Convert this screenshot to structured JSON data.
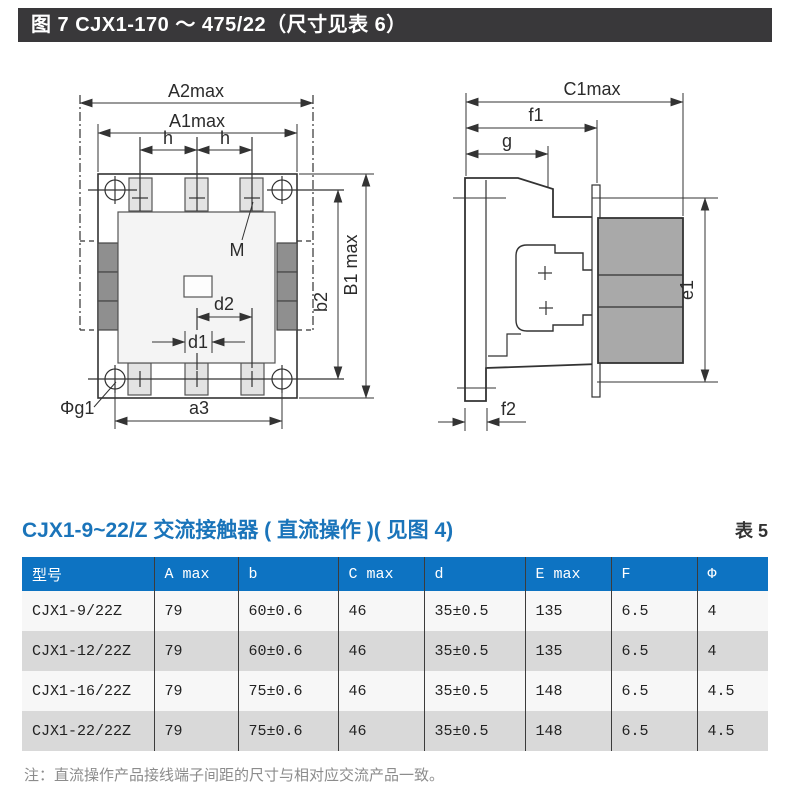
{
  "header_bar": {
    "text": "图 7 CJX1-170 ～ 475/22（尺寸见表 6）",
    "bg": "#39383a",
    "fg": "#ffffff"
  },
  "fig": {
    "front": {
      "a2max": "A2max",
      "a1max": "A1max",
      "h1": "h",
      "h2": "h",
      "m": "M",
      "b2": "b2",
      "b1max": "B1 max",
      "d2": "d2",
      "d1": "d1",
      "a3": "a3",
      "phig1": "Φg1"
    },
    "side": {
      "c1max": "C1max",
      "f1": "f1",
      "g": "g",
      "e1": "e1",
      "f2": "f2"
    }
  },
  "section": {
    "title": "CJX1-9~22/Z 交流接触器 ( 直流操作 )( 见图 4)",
    "tag": "表 5"
  },
  "table": {
    "headers": [
      "型号",
      "A max",
      "b",
      "C max",
      "d",
      "E max",
      "F",
      "Φ"
    ],
    "rows": [
      [
        "CJX1-9/22Z",
        "79",
        "60±0.6",
        "46",
        "35±0.5",
        "135",
        "6.5",
        "4"
      ],
      [
        "CJX1-12/22Z",
        "79",
        "60±0.6",
        "46",
        "35±0.5",
        "135",
        "6.5",
        "4"
      ],
      [
        "CJX1-16/22Z",
        "79",
        "75±0.6",
        "46",
        "35±0.5",
        "148",
        "6.5",
        "4.5"
      ],
      [
        "CJX1-22/22Z",
        "79",
        "75±0.6",
        "46",
        "35±0.5",
        "148",
        "6.5",
        "4.5"
      ]
    ]
  },
  "note": {
    "text": "注：直流操作产品接线端子间距的尺寸与相对应交流产品一致。"
  },
  "colors": {
    "header_bar_bg": "#39383a",
    "title_blue": "#1a74ba",
    "table_header_bg": "#0d73c2",
    "row": "#f7f7f7",
    "row_alt": "#d9d9d9",
    "note_gray": "#8c8c8c",
    "diagram_gray": "#a9a9a9"
  }
}
